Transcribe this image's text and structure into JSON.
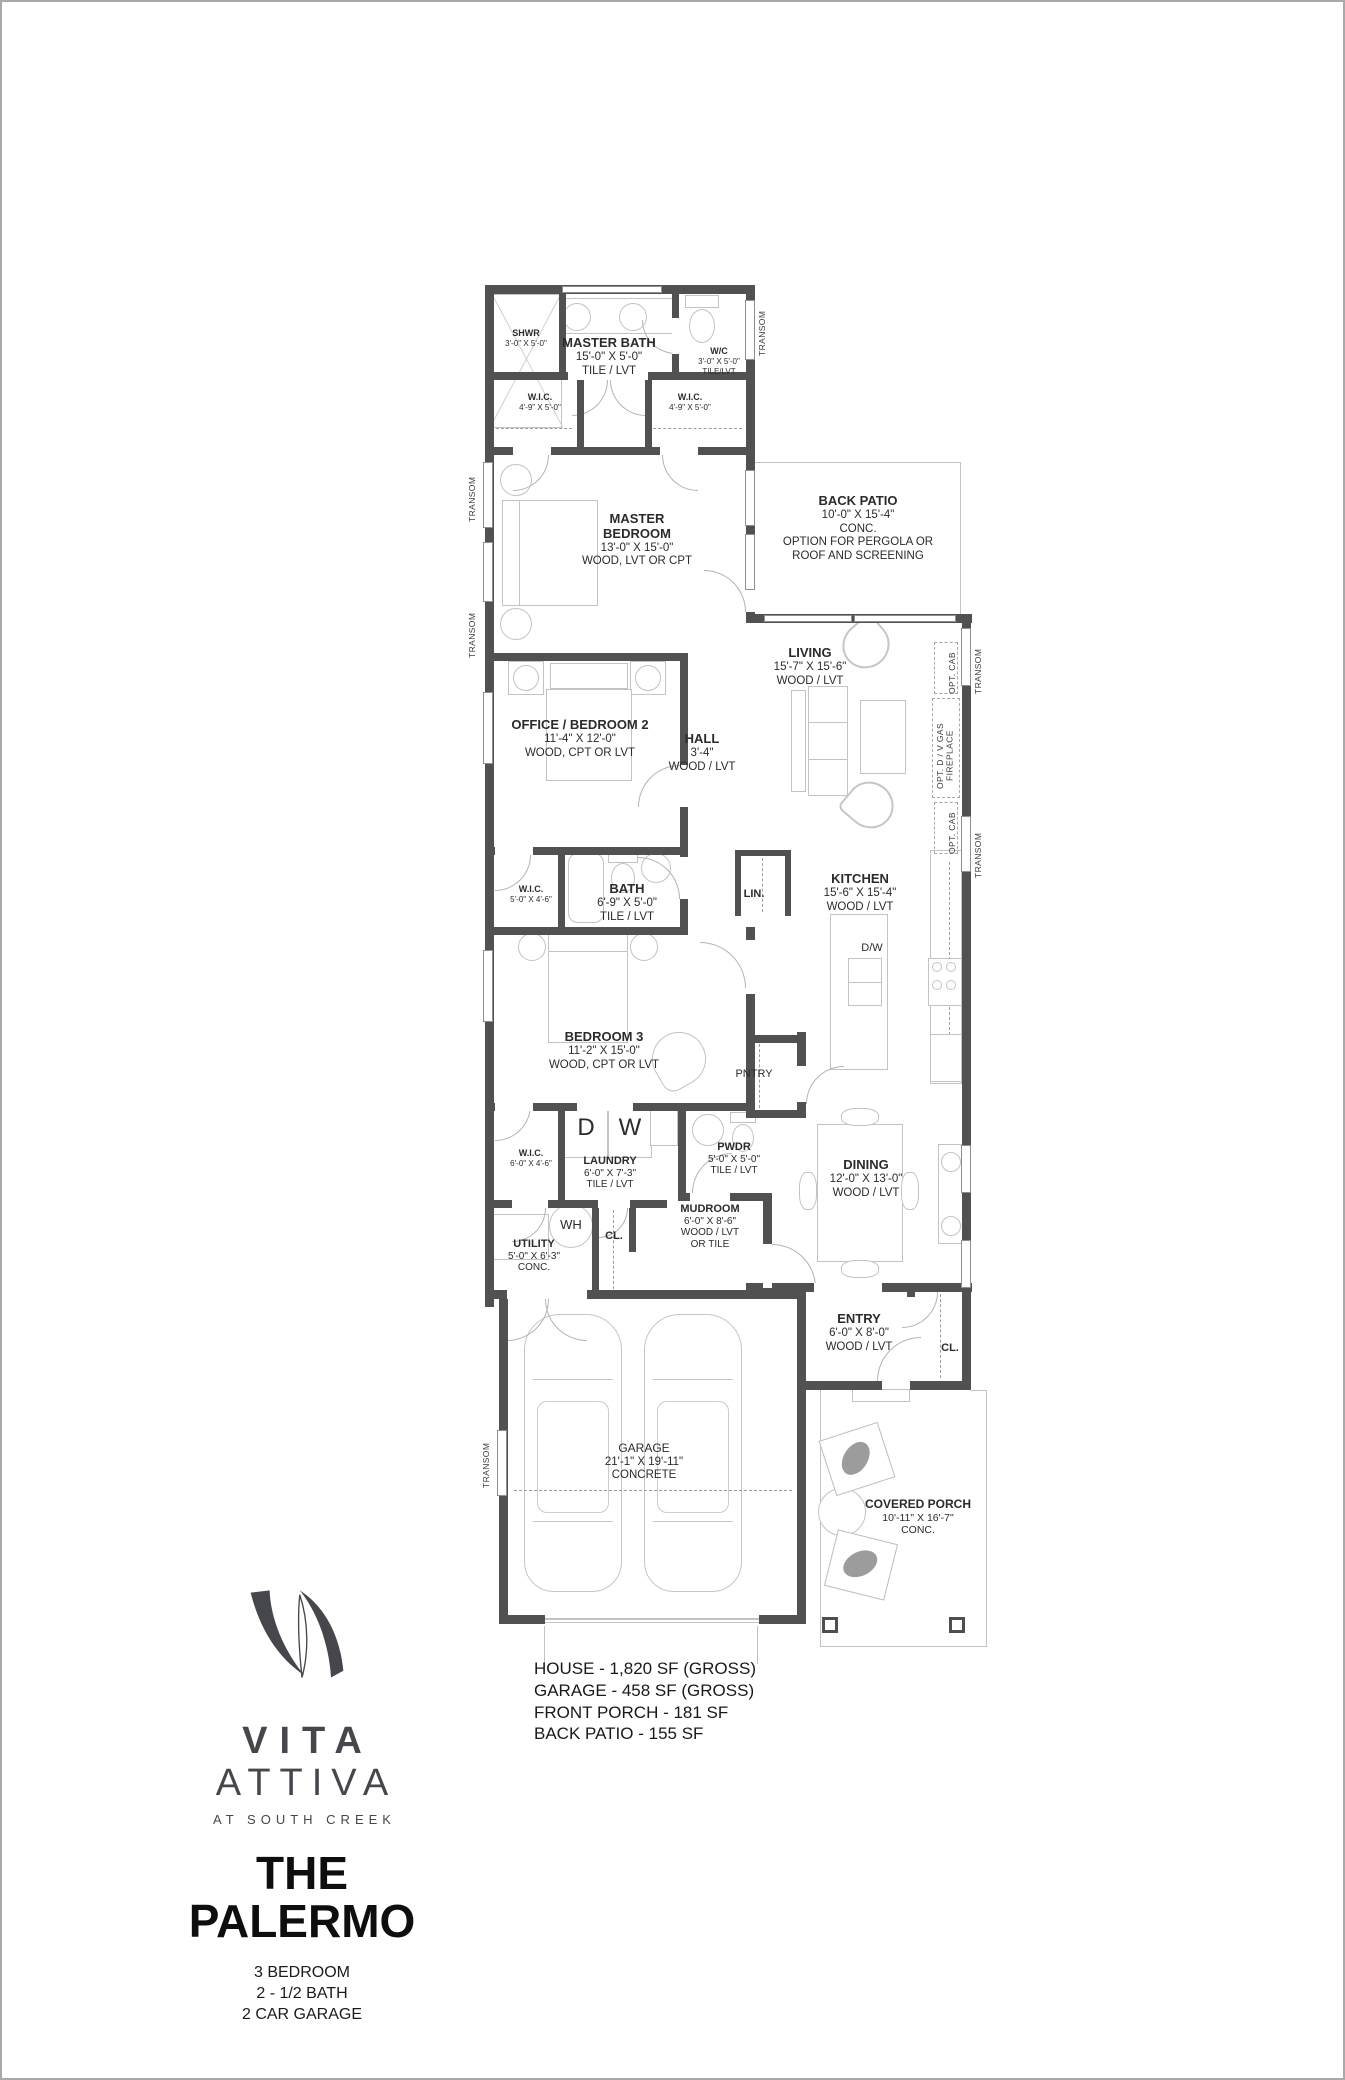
{
  "branding": {
    "name_line1": "VITA",
    "name_line2": "ATTIVA",
    "tagline": "AT SOUTH CREEK",
    "plan_name_line1": "THE",
    "plan_name_line2": "PALERMO",
    "specs": [
      "3 BEDROOM",
      "2 - 1/2 BATH",
      "2 CAR GARAGE"
    ],
    "logo_color": "#46464d"
  },
  "areas": {
    "lines": [
      "HOUSE - 1,820 SF (GROSS)",
      "GARAGE - 458 SF (GROSS)",
      "FRONT PORCH - 181 SF",
      "BACK PATIO - 155 SF"
    ]
  },
  "rooms": {
    "master_bath": {
      "name": "MASTER BATH",
      "dims": "15'-0\" X 5'-0\"",
      "floor": "TILE / LVT"
    },
    "shwr": {
      "name": "SHWR",
      "dims": "3'-0\" X 5'-0\""
    },
    "wc": {
      "name": "W/C",
      "dims": "3'-0\" X 5'-0\"",
      "floor": "TILE/LVT"
    },
    "wic_master_left": {
      "name": "W.I.C.",
      "dims": "4'-9\" X 5'-0\""
    },
    "wic_master_right": {
      "name": "W.I.C.",
      "dims": "4'-9\" X 5'-0\""
    },
    "master_bedroom": {
      "name": "MASTER\nBEDROOM",
      "dims": "13'-0\" X 15'-0\"",
      "floor": "WOOD, LVT OR CPT"
    },
    "back_patio": {
      "name": "BACK PATIO",
      "dims": "10'-0\" X 15'-4\"",
      "floor": "CONC.",
      "note": "OPTION FOR PERGOLA OR\nROOF AND SCREENING"
    },
    "living": {
      "name": "LIVING",
      "dims": "15'-7\" X 15'-6\"",
      "floor": "WOOD / LVT"
    },
    "office": {
      "name": "OFFICE / BEDROOM 2",
      "dims": "11'-4\" X 12'-0\"",
      "floor": "WOOD, CPT OR LVT"
    },
    "hall": {
      "name": "HALL",
      "dims": "3'-4\"",
      "floor": "WOOD / LVT"
    },
    "wic_hall": {
      "name": "W.I.C.",
      "dims": "5'-0\" X 4'-6\""
    },
    "bath": {
      "name": "BATH",
      "dims": "6'-9\" X 5'-0\"",
      "floor": "TILE / LVT"
    },
    "lin": {
      "name": "LIN."
    },
    "kitchen": {
      "name": "KITCHEN",
      "dims": "15'-6\" X 15'-4\"",
      "floor": "WOOD / LVT"
    },
    "bedroom3": {
      "name": "BEDROOM 3",
      "dims": "11'-2\" X 15'-0\"",
      "floor": "WOOD, CPT OR LVT"
    },
    "pntry": {
      "name": "PNTRY"
    },
    "wic_bed3": {
      "name": "W.I.C.",
      "dims": "6'-0\" X 4'-6\""
    },
    "laundry": {
      "name": "LAUNDRY",
      "dims": "6'-0\" X 7'-3\"",
      "floor": "TILE / LVT"
    },
    "pwdr": {
      "name": "PWDR",
      "dims": "5'-0\" X 5'-0\"",
      "floor": "TILE / LVT"
    },
    "mudroom": {
      "name": "MUDROOM",
      "dims": "6'-0\" X 8'-6\"",
      "floor": "WOOD / LVT\nOR TILE"
    },
    "utility": {
      "name": "UTILITY",
      "dims": "5'-0\" X 6'-3\"",
      "floor": "CONC."
    },
    "cl_mud": {
      "name": "CL."
    },
    "dining": {
      "name": "DINING",
      "dims": "12'-0\" X 13'-0\"",
      "floor": "WOOD / LVT"
    },
    "entry": {
      "name": "ENTRY",
      "dims": "6'-0\" X 8'-0\"",
      "floor": "WOOD / LVT"
    },
    "cl_entry": {
      "name": "CL."
    },
    "garage": {
      "name": "GARAGE",
      "dims": "21'-1\" X 19'-11\"",
      "floor": "CONCRETE"
    },
    "covered_porch": {
      "name": "COVERED PORCH",
      "dims": "10'-11\" X 16'-7\"",
      "floor": "CONC."
    }
  },
  "fixtures": {
    "dw": "D/W",
    "dryer": "D",
    "washer": "W",
    "water_heater": "WH"
  },
  "annot": {
    "transom": "TRANSOM",
    "opt_cab": "OPT. CAB",
    "fireplace": "OPT. D / V GAS FIREPLACE"
  }
}
